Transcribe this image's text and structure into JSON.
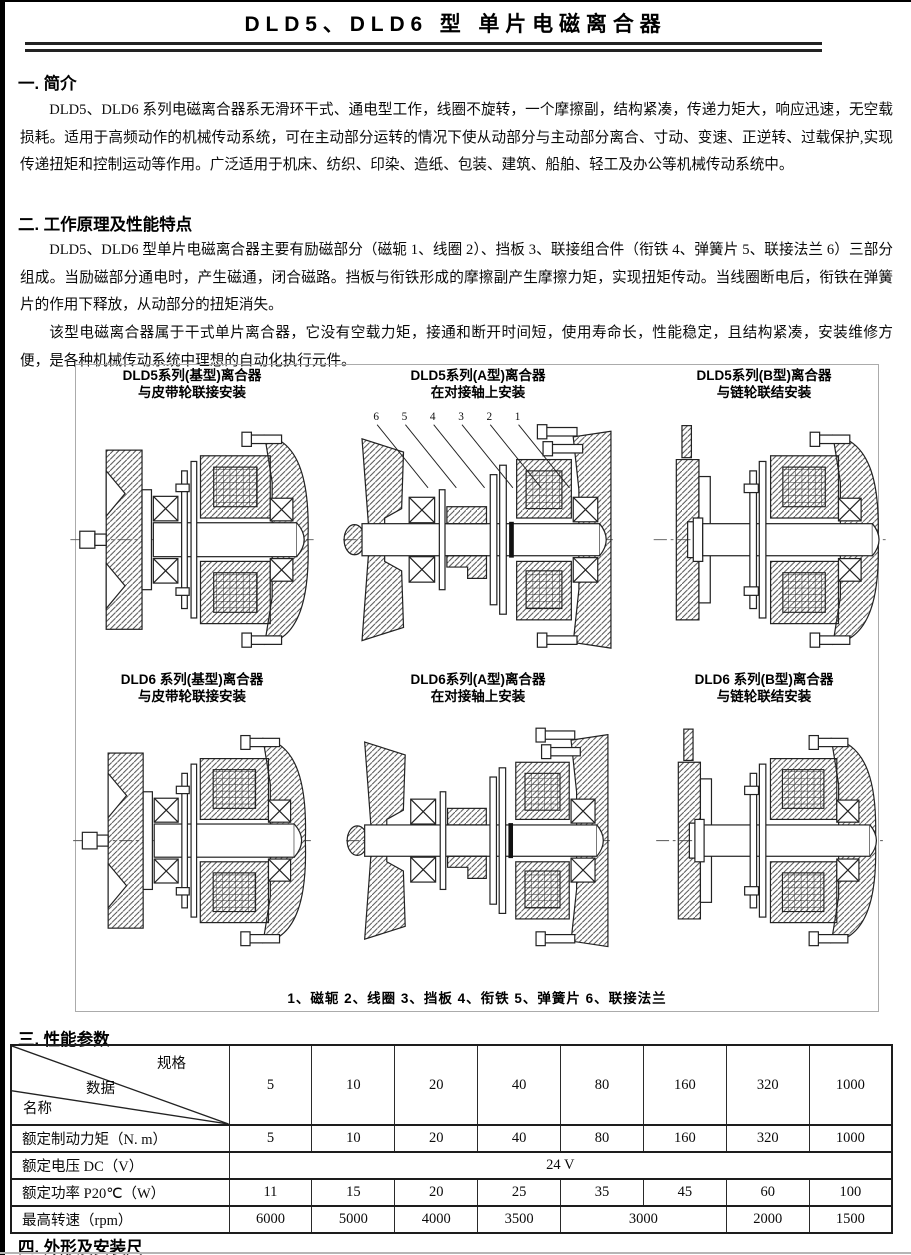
{
  "page": {
    "title": "DLD5、DLD6 型  单片电磁离合器"
  },
  "sections": {
    "s1": {
      "heading": "一. 简介",
      "p1": "DLD5、DLD6 系列电磁离合器系无滑环干式、通电型工作，线圈不旋转，一个摩擦副，结构紧凑，传递力矩大，响应迅速，无空载损耗。适用于高频动作的机械传动系统，可在主动部分运转的情况下使从动部分与主动部分离合、寸动、变速、正逆转、过载保护,实现传递扭矩和控制运动等作用。广泛适用于机床、纺织、印染、造纸、包装、建筑、船舶、轻工及办公等机械传动系统中。"
    },
    "s2": {
      "heading": "二. 工作原理及性能特点",
      "p1": "DLD5、DLD6 型单片电磁离合器主要有励磁部分（磁轭 1、线圈 2）、挡板 3、联接组合件（衔铁 4、弹簧片 5、联接法兰 6）三部分组成。当励磁部分通电时，产生磁通，闭合磁路。挡板与衔铁形成的摩擦副产生摩擦力矩，实现扭矩传动。当线圈断电后，衔铁在弹簧片的作用下释放，从动部分的扭矩消失。",
      "p2": "该型电磁离合器属于干式单片离合器，它没有空载力矩，接通和断开时间短，使用寿命长，性能稳定，且结构紧凑，安装维修方便，是各种机械传动系统中理想的自动化执行元件。"
    },
    "s3": {
      "heading": "三. 性能参数"
    },
    "s4": {
      "heading": "四. 外形及安装尺"
    }
  },
  "figure": {
    "diagrams": [
      {
        "caption_line1": "DLD5系列(基型)离合器",
        "caption_line2": "与皮带轮联接安装"
      },
      {
        "caption_line1": "DLD5系列(A型)离合器",
        "caption_line2": "在对接轴上安装",
        "callouts": [
          "6",
          "5",
          "4",
          "3",
          "2",
          "1"
        ]
      },
      {
        "caption_line1": "DLD5系列(B型)离合器",
        "caption_line2": "与链轮联结安装"
      },
      {
        "caption_line1": "DLD6 系列(基型)离合器",
        "caption_line2": "与皮带轮联接安装"
      },
      {
        "caption_line1": "DLD6系列(A型)离合器",
        "caption_line2": "在对接轴上安装"
      },
      {
        "caption_line1": "DLD6 系列(B型)离合器",
        "caption_line2": "与链轮联结安装"
      }
    ],
    "legend": "1、磁轭  2、线圈  3、挡板  4、衔铁  5、弹簧片  6、联接法兰"
  },
  "table": {
    "corner": {
      "top": "规格",
      "mid": "数据",
      "bottom": "名称"
    },
    "spec_columns": [
      "5",
      "10",
      "20",
      "40",
      "80",
      "160",
      "320",
      "1000"
    ],
    "rows": [
      {
        "label": "额定制动力矩（N. m）",
        "cells": [
          "5",
          "10",
          "20",
          "40",
          "80",
          "160",
          "320",
          "1000"
        ],
        "spans": [
          1,
          1,
          1,
          1,
          1,
          1,
          1,
          1
        ]
      },
      {
        "label": "额定电压 DC（V）",
        "cells": [
          "24 V"
        ],
        "spans": [
          8
        ]
      },
      {
        "label": "额定功率 P20℃（W）",
        "cells": [
          "11",
          "15",
          "20",
          "25",
          "35",
          "45",
          "60",
          "100"
        ],
        "spans": [
          1,
          1,
          1,
          1,
          1,
          1,
          1,
          1
        ]
      },
      {
        "label": "最高转速（rpm）",
        "cells": [
          "6000",
          "5000",
          "4000",
          "3500",
          "3000",
          "2000",
          "1500"
        ],
        "spans": [
          1,
          1,
          1,
          1,
          2,
          1,
          1
        ]
      }
    ]
  }
}
